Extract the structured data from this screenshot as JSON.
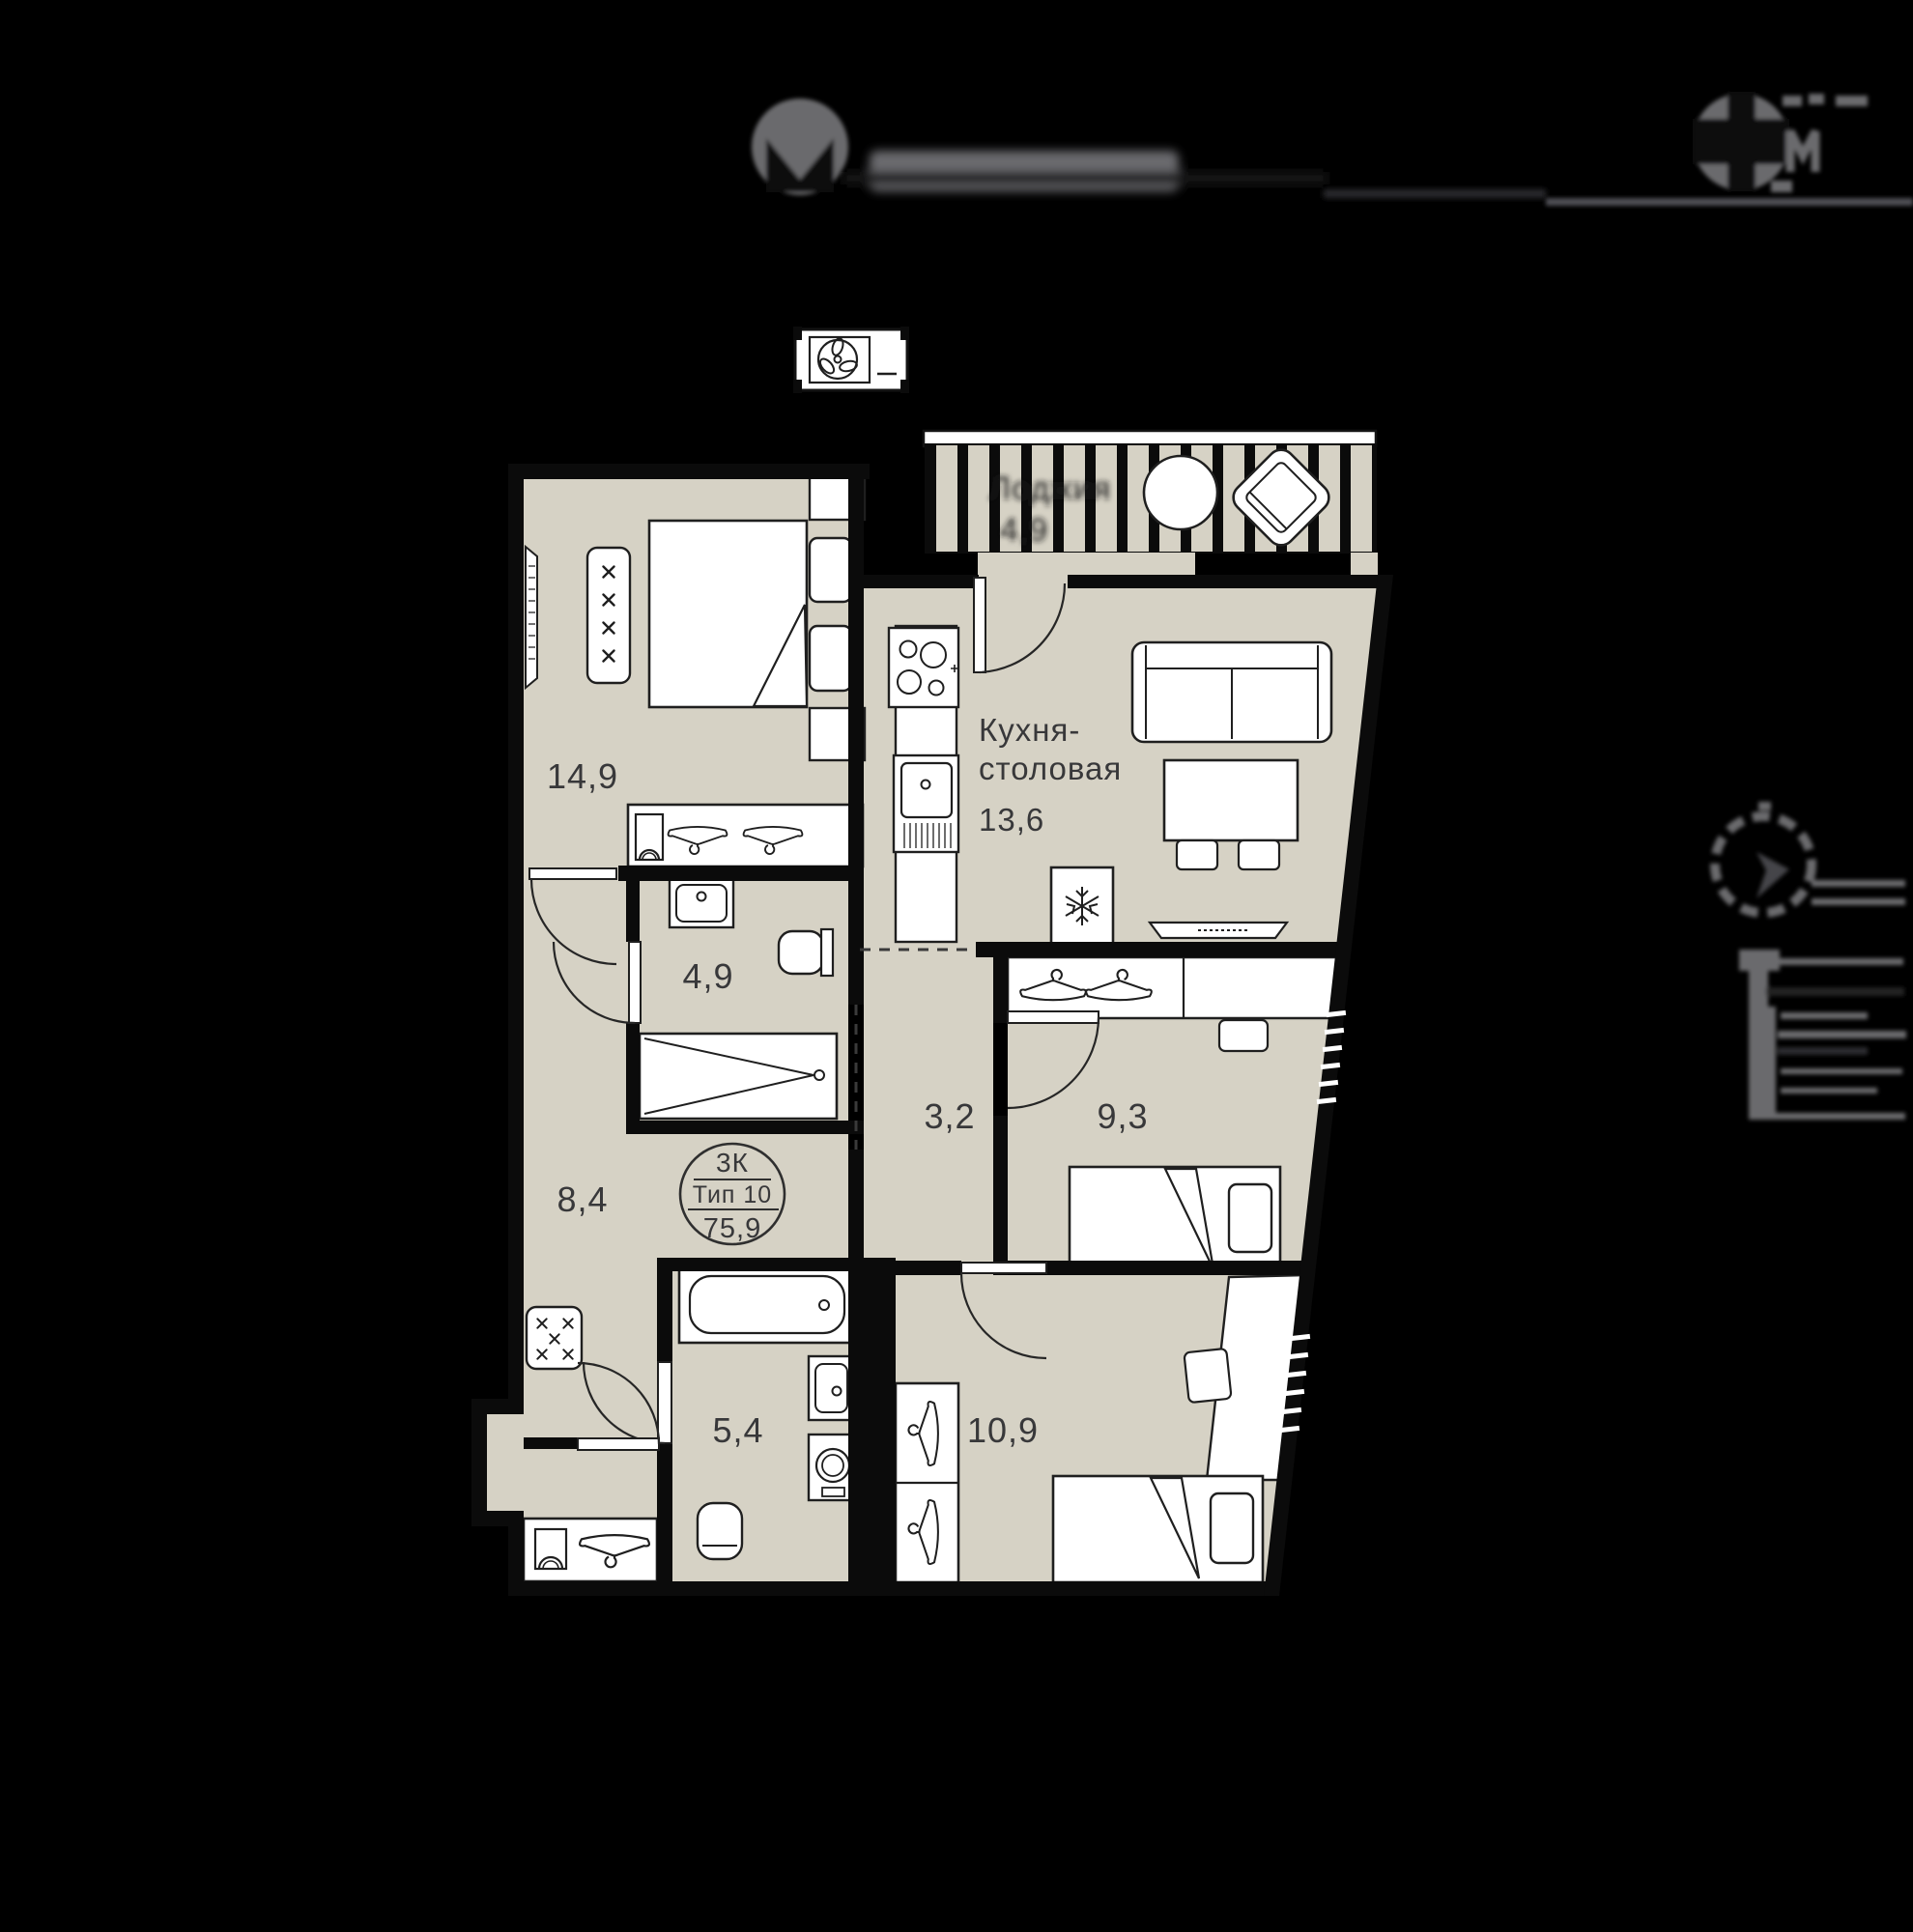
{
  "apartment": {
    "badge": {
      "rooms": "3К",
      "type": "Тип 10",
      "total_area": "75,9"
    },
    "kitchen": {
      "name_line1": "Кухня-",
      "name_line2": "столовая",
      "area": "13,6"
    },
    "loggia": {
      "name": "Лоджия",
      "area": "4,9"
    },
    "room_areas": {
      "bedroom_main": "14,9",
      "bathroom_top": "4,9",
      "hallway": "8,4",
      "bathroom_bottom": "5,4",
      "corridor": "3,2",
      "bedroom_middle": "9,3",
      "bedroom_bottom": "10,9"
    }
  },
  "colors": {
    "background": "#000000",
    "floor": "#d6d2c5",
    "wall": "#0b0b0b",
    "furniture": "#ffffff",
    "label_text": "#38383a",
    "header_gray": "#6a6a6d"
  }
}
